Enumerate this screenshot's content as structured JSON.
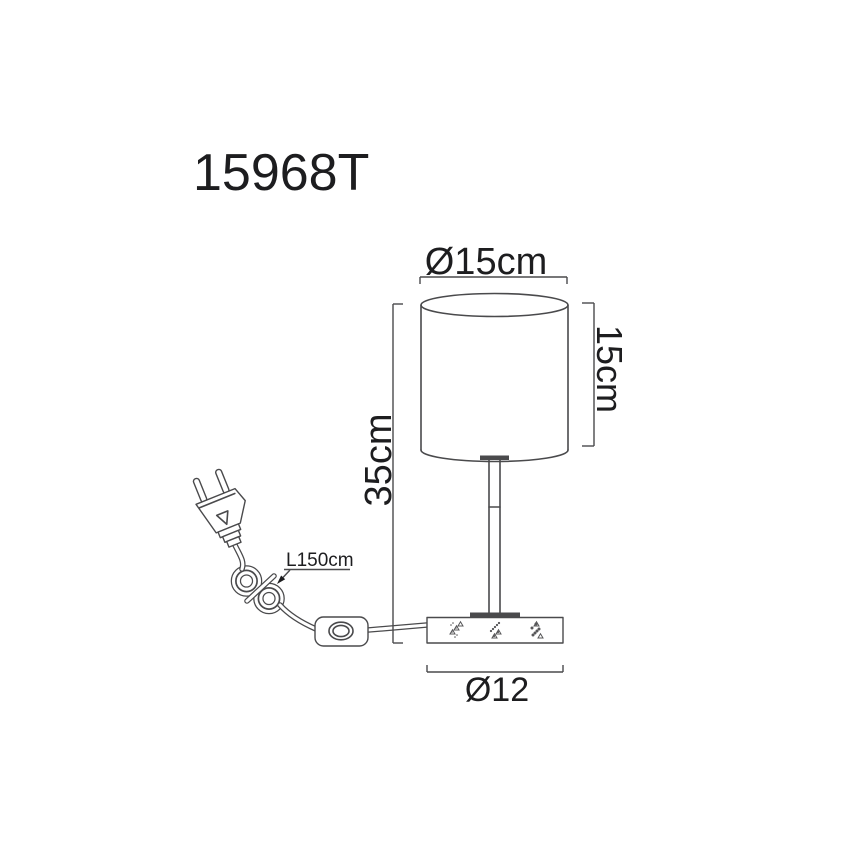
{
  "model_number": "15968T",
  "labels": {
    "shade_diameter": "Ø15cm",
    "shade_height": "15cm",
    "total_height": "35cm",
    "cable_length": "L150cm",
    "base_diameter": "Ø12"
  },
  "colors": {
    "line": "#4a4a4c",
    "text": "#1d1d1f",
    "background": "#ffffff"
  }
}
